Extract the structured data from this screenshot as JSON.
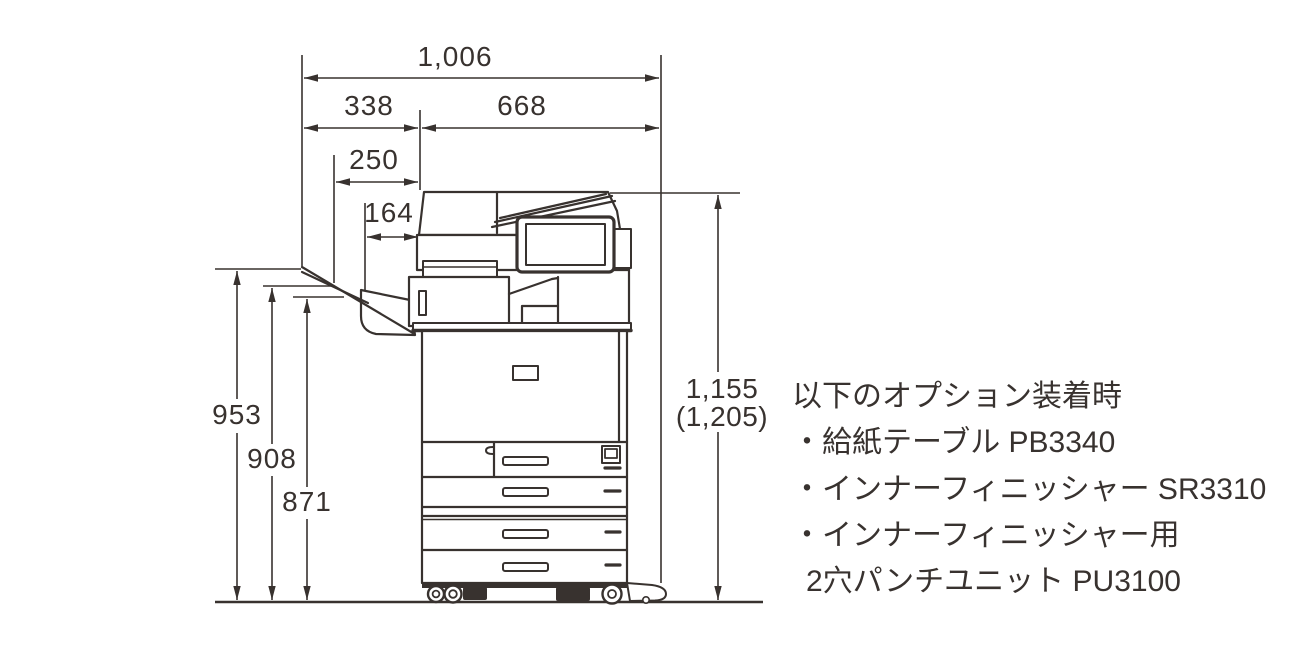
{
  "page": {
    "background": "#ffffff",
    "line_color": "#38322f"
  },
  "dimensions": {
    "total_width": "1,006",
    "left_section_width": "338",
    "body_width": "668",
    "tray_extension_width": "250",
    "tray_inner_width": "164",
    "tray_height_top": "953",
    "tray_height_mid": "908",
    "tray_height_low": "871",
    "body_height": "1,155",
    "body_height_with_option": "(1,205)"
  },
  "notes": {
    "heading": "以下のオプション装着時",
    "lines": [
      "・給紙テーブル PB3340",
      "・インナーフィニッシャー SR3310",
      "・インナーフィニッシャー用",
      "2穴パンチユニット PU3100"
    ]
  }
}
